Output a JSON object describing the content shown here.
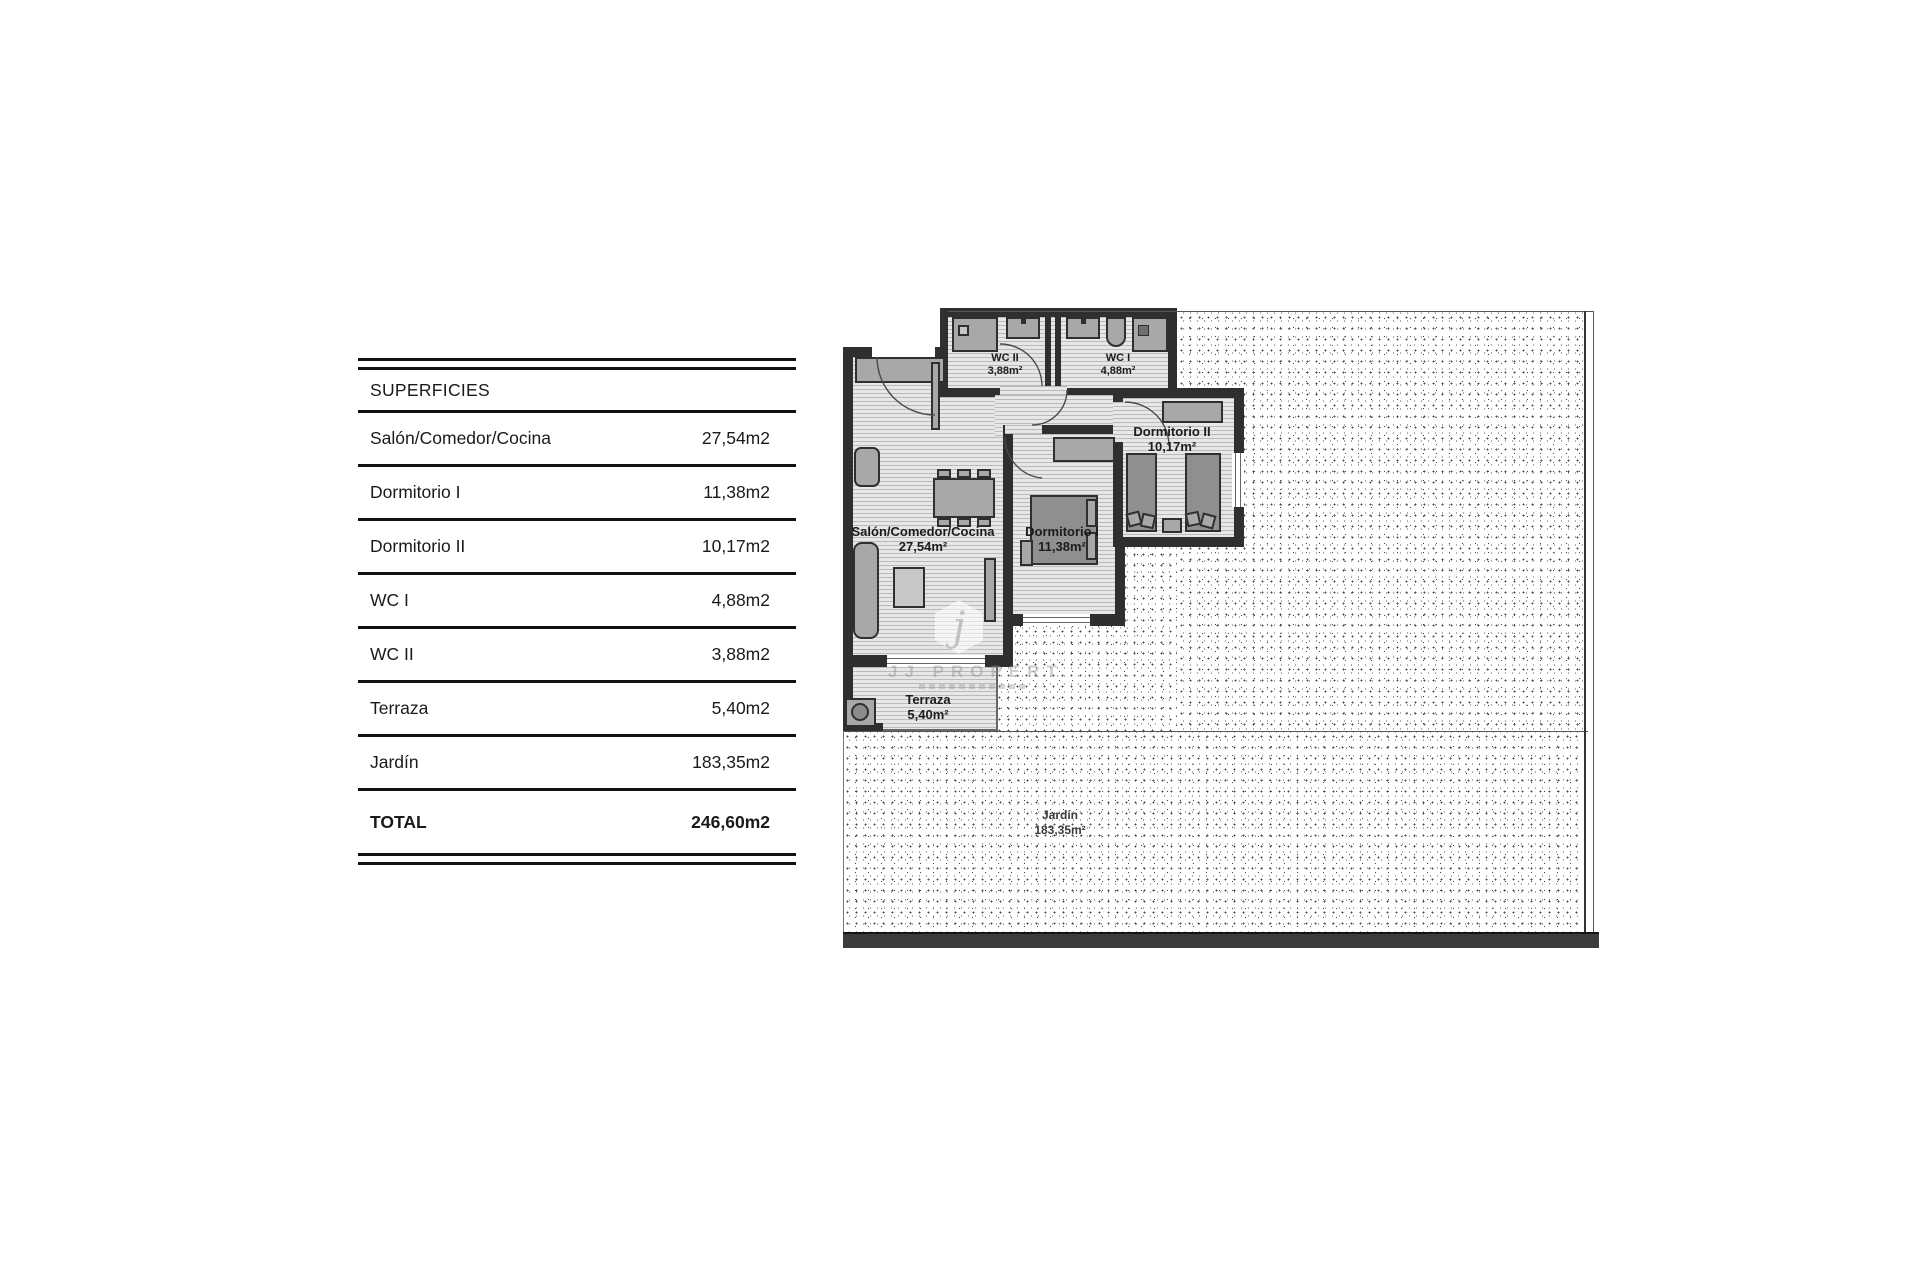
{
  "page_title": "Apartment floor plan with surfaces table",
  "table": {
    "header": "SUPERFICIES",
    "rows": [
      {
        "label": "Salón/Comedor/Cocina",
        "value": "27,54m2"
      },
      {
        "label": "Dormitorio I",
        "value": "11,38m2"
      },
      {
        "label": "Dormitorio II",
        "value": "10,17m2"
      },
      {
        "label": "WC I",
        "value": "4,88m2"
      },
      {
        "label": "WC II",
        "value": "3,88m2"
      },
      {
        "label": "Terraza",
        "value": "5,40m2"
      },
      {
        "label": "Jardín",
        "value": "183,35m2"
      }
    ],
    "total": {
      "label": "TOTAL",
      "value": "246,60m2"
    }
  },
  "floorplan": {
    "labels": {
      "wc2": {
        "name": "WC II",
        "area": "3,88m²"
      },
      "wc1": {
        "name": "WC I",
        "area": "4,88m²"
      },
      "dorm2": {
        "name": "Dormitorio II",
        "area": "10,17m²"
      },
      "dorm1": {
        "name": "Dormitorio I",
        "area": "11,38m²"
      },
      "salon": {
        "name": "Salón/Comedor/Cocina",
        "area": "27,54m²"
      },
      "terraza": {
        "name": "Terraza",
        "area": "5,40m²"
      },
      "jardin": {
        "name": "Jardín",
        "area": "183,35m²"
      }
    },
    "watermark": {
      "initial": "j",
      "text": "JJ PROPERTI"
    }
  },
  "colors": {
    "wall": "#2f2f2f",
    "room_floor": "#e7e7e7",
    "furniture": "#a8a8a8",
    "stipple_dot": "#4a4a4a",
    "text": "#1a1a1a"
  }
}
